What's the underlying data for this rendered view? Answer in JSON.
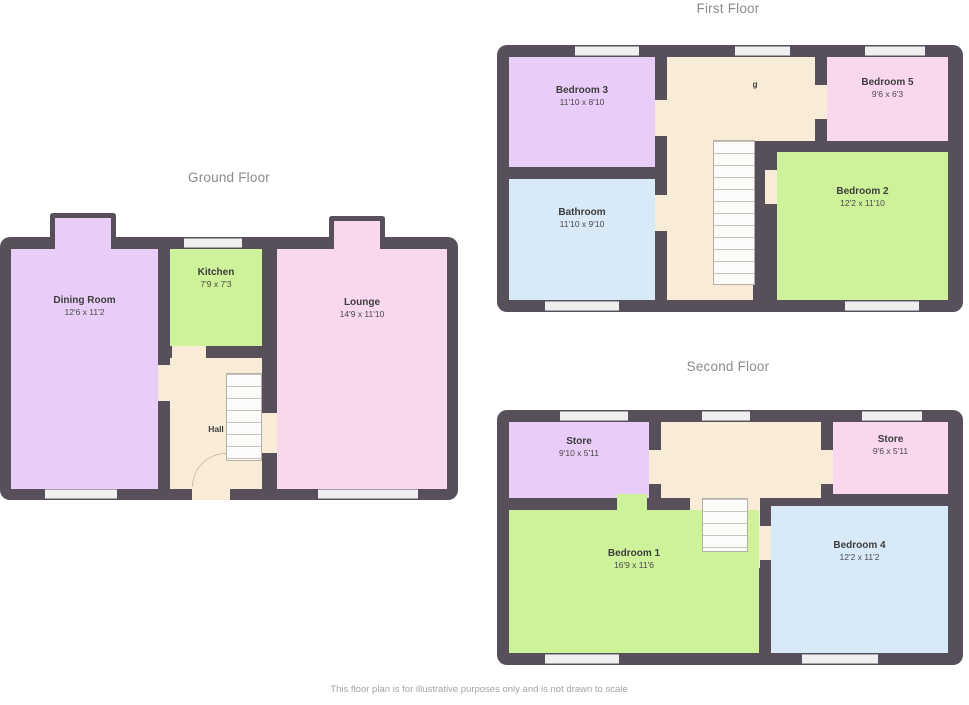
{
  "colors": {
    "wall": "#57505b",
    "hallway": "#f8ecd7",
    "room_purple": "#e7cdf8",
    "room_green": "#cdf29a",
    "room_pink": "#f9d7ec",
    "room_blue": "#d8e9f8",
    "stairs": "#fbfbfa",
    "window": "#efefef",
    "title_text": "#8c8c8c",
    "room_text": "#3d3d3d"
  },
  "floors": {
    "ground": {
      "title": "Ground Floor",
      "rooms": {
        "dining": {
          "name": "Dining Room",
          "dims": "12'6 x 11'2"
        },
        "kitchen": {
          "name": "Kitchen",
          "dims": "7'9 x 7'3"
        },
        "lounge": {
          "name": "Lounge",
          "dims": "14'9 x 11'10"
        },
        "hall": {
          "name": "Hall"
        }
      }
    },
    "first": {
      "title": "First Floor",
      "rooms": {
        "bedroom3": {
          "name": "Bedroom 3",
          "dims": "11'10 x 8'10"
        },
        "bathroom": {
          "name": "Bathroom",
          "dims": "11'10 x 9'10"
        },
        "bedroom5": {
          "name": "Bedroom 5",
          "dims": "9'6 x 6'3"
        },
        "bedroom2": {
          "name": "Bedroom 2",
          "dims": "12'2 x 11'10"
        },
        "landing": {
          "name": "Landing"
        }
      }
    },
    "second": {
      "title": "Second Floor",
      "rooms": {
        "store": {
          "name": "Store",
          "dims": "9'10 x 5'11"
        },
        "eaves": {
          "name": "Store",
          "dims": "9'6 x 5'11"
        },
        "bedroom1": {
          "name": "Bedroom 1",
          "dims": "16'9 x 11'6"
        },
        "bedroom4": {
          "name": "Bedroom 4",
          "dims": "12'2 x 11'2"
        },
        "landing": {
          "name": "Landing"
        }
      }
    }
  },
  "footer": {
    "disclaimer": "This floor plan is for illustrative purposes only and is not drawn to scale"
  }
}
